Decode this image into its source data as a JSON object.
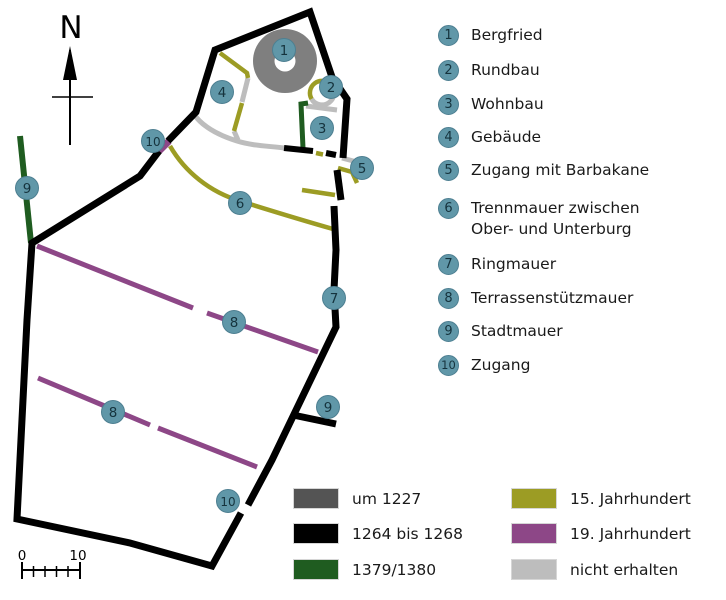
{
  "colors": {
    "marker_fill": "#6097a8",
    "marker_border": "#4d7f91",
    "marker_text": "#15333d",
    "tower_1227": "#7f7f7f",
    "swatch_1227": "#545454",
    "wall_1264": "#000000",
    "wall_1379": "#1f5c20",
    "wall_15jh": "#9c9c24",
    "wall_19jh": "#8d4787",
    "wall_lost": "#bdbdbd"
  },
  "compass": {
    "label": "N"
  },
  "scale_bar": {
    "start_label": "0",
    "end_label": "10"
  },
  "numbered_legend": [
    {
      "num": "1",
      "label": "Bergfried"
    },
    {
      "num": "2",
      "label": "Rundbau"
    },
    {
      "num": "3",
      "label": "Wohnbau"
    },
    {
      "num": "4",
      "label": "Gebäude"
    },
    {
      "num": "5",
      "label": "Zugang mit Barbakane"
    },
    {
      "num": "6",
      "label": "Trennmauer zwischen",
      "label2": "Ober- und Unterburg"
    },
    {
      "num": "7",
      "label": "Ringmauer"
    },
    {
      "num": "8",
      "label": "Terrassenstützmauer"
    },
    {
      "num": "9",
      "label": "Stadtmauer"
    },
    {
      "num": "10",
      "label": "Zugang"
    }
  ],
  "period_legend": {
    "left": [
      {
        "key": "um-1227",
        "color": "#545454",
        "label": "um 1227"
      },
      {
        "key": "1264-1268",
        "color": "#000000",
        "label": "1264 bis 1268"
      },
      {
        "key": "1379-1380",
        "color": "#1f5c20",
        "label": "1379/1380"
      }
    ],
    "right": [
      {
        "key": "15-jahrhundert",
        "color": "#9c9c24",
        "label": "15. Jahrhundert"
      },
      {
        "key": "19-jahrhundert",
        "color": "#8d4787",
        "label": "19. Jahrhundert"
      },
      {
        "key": "nicht-erhalten",
        "color": "#bdbdbd",
        "label": "nicht erhalten"
      }
    ]
  },
  "map_markers": [
    {
      "num": "1",
      "x": 284,
      "y": 50
    },
    {
      "num": "2",
      "x": 331,
      "y": 87
    },
    {
      "num": "3",
      "x": 322,
      "y": 128
    },
    {
      "num": "4",
      "x": 222,
      "y": 92
    },
    {
      "num": "5",
      "x": 362,
      "y": 168
    },
    {
      "num": "6",
      "x": 240,
      "y": 203
    },
    {
      "num": "7",
      "x": 334,
      "y": 298
    },
    {
      "num": "8",
      "x": 234,
      "y": 322
    },
    {
      "num": "8",
      "x": 113,
      "y": 412
    },
    {
      "num": "9",
      "x": 27,
      "y": 188
    },
    {
      "num": "9",
      "x": 328,
      "y": 407
    },
    {
      "num": "10",
      "x": 153,
      "y": 141
    },
    {
      "num": "10",
      "x": 228,
      "y": 501
    }
  ]
}
